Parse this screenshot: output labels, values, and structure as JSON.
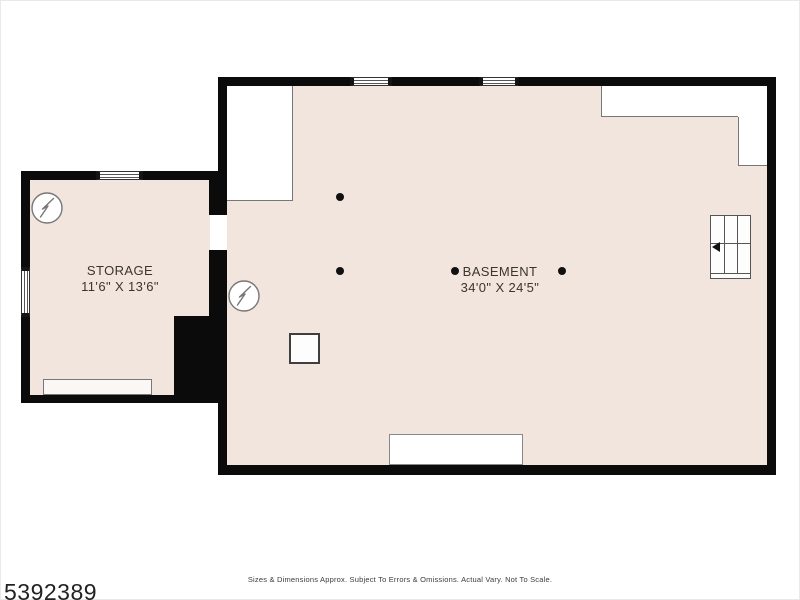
{
  "title": "Basement floor plan",
  "colors": {
    "floor": "#f2e5de",
    "wall": "#0b0b0b",
    "background": "#ffffff",
    "symbol_outline": "#777777"
  },
  "rooms": {
    "storage": {
      "name": "STORAGE",
      "dimensions": "11'6\" X 13'6\""
    },
    "basement": {
      "name": "BASEMENT",
      "dimensions": "34'0\" X 24'5\""
    }
  },
  "symbols": {
    "electrical": "lightning-bolt-circle",
    "stairs": "staircase-with-left-arrow",
    "columns": "support-column-dots",
    "windows": "double-line-window"
  },
  "footer": {
    "listing_number": "5392389",
    "disclaimer": "Sizes & Dimensions Approx. Subject To Errors & Omissions. Actual Vary. Not To Scale."
  }
}
